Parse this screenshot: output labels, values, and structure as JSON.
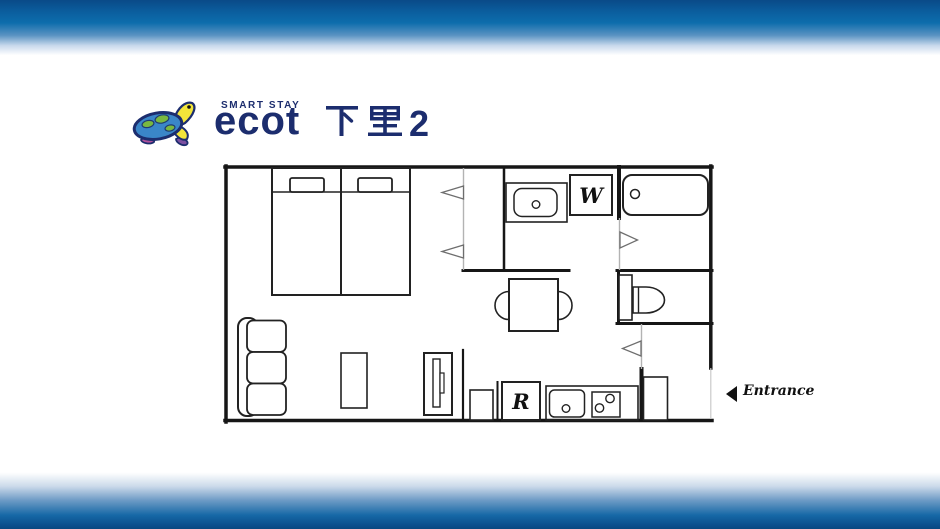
{
  "banner": {
    "top_gradient": [
      "#0a4a88",
      "#0d6dac",
      "#ffffff"
    ],
    "bottom_gradient": [
      "#ffffff",
      "#1668a6",
      "#09487f"
    ]
  },
  "logo": {
    "tagline": "SMART STAY",
    "brand": "ecot",
    "property_name": "下里2",
    "property_number": "2",
    "brand_color": "#1c2d6e",
    "turtle_colors": {
      "shell": "#3a86c8",
      "spots": "#79b83f",
      "head": "#f2e53a",
      "flipper_purple": "#7c4fa0",
      "flipper_magenta": "#b0519c",
      "outline": "#1c2d6e"
    }
  },
  "floorplan": {
    "washer_label": "W",
    "refrigerator_label": "R",
    "entrance_label": "Entrance",
    "wall_color": "#161616",
    "door_line_color": "#b3b3b3"
  }
}
